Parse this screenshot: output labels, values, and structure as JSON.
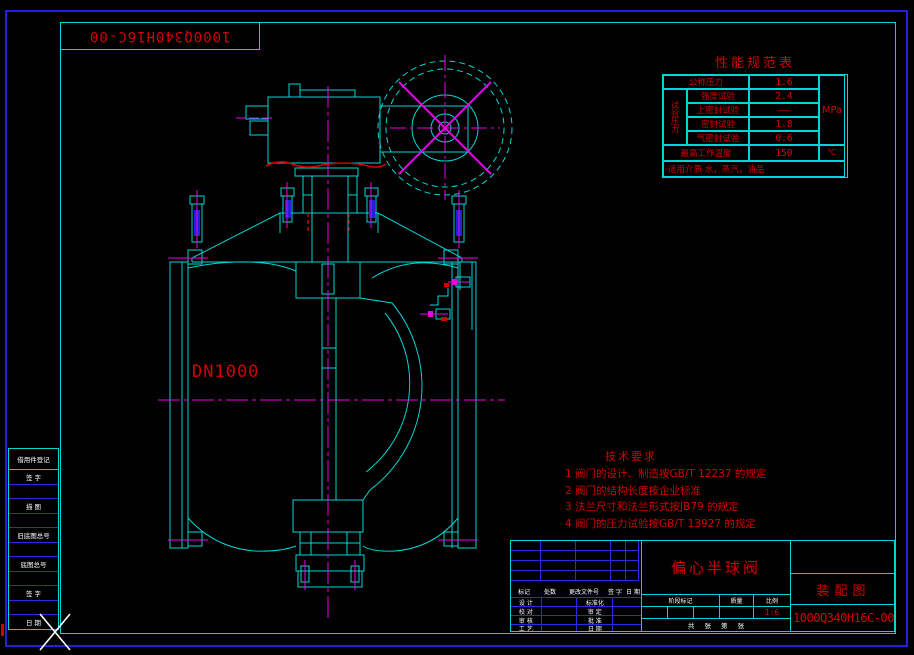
{
  "drawing": {
    "corner_label": "1000Q340H16C-00",
    "size_label": "DN1000",
    "spec_table": {
      "title": "性能规范表",
      "pressure_group_label": "试验压力",
      "rows": [
        {
          "label": "公称压力",
          "value": "1.6"
        },
        {
          "label": "强度试验",
          "value": "2.4"
        },
        {
          "label": "上密封试验",
          "value": "——"
        },
        {
          "label": "密封试验",
          "value": "1.8"
        },
        {
          "label": "气密封试验",
          "value": "0.6"
        }
      ],
      "pressure_unit": "MPa",
      "temp_row": {
        "label": "最高工作温度",
        "value": "150",
        "unit": "℃"
      },
      "media_row": "适用介质 水，蒸汽，油品"
    },
    "tech_requirements": {
      "title": "技术要求",
      "items": [
        "1  阀门的设计、制造按GB/T 12237 的规定",
        "2  阀门的结构长度按企业标准",
        "3  法兰尺寸和法兰形式按JB79 的规定",
        "4  阀门的压力试验按GB/T 13927 的规定"
      ]
    },
    "title_block": {
      "product_name": "偏心半球阀",
      "sheet_type": "装配图",
      "drawing_no": "1000Q340H16C-00",
      "rev_headers": [
        "标记",
        "处数",
        "更改文件号",
        "签 字",
        "日 期"
      ],
      "sig_left": [
        "设 计",
        "校 对",
        "审 核",
        "工 艺"
      ],
      "sig_mid": [
        "标准化",
        "审 定",
        "批 准",
        "日 期"
      ],
      "stage_headers": [
        "阶段标记",
        "质量",
        "比例"
      ],
      "scale": "1:6",
      "sheet_count": "共 张 第 张"
    },
    "margin_strip": {
      "rows": [
        "借用件登记",
        "签 字",
        "",
        "描 图",
        "",
        "旧底图总号",
        "",
        "底图总号",
        "",
        "签 字",
        "",
        "日 期"
      ]
    },
    "colors": {
      "line_cyan": "#00d6d6",
      "centerline_magenta": "#e800e8",
      "text_red": "#d40000",
      "grid_blue": "#2a2ae0",
      "text_white": "#ffffff"
    }
  }
}
